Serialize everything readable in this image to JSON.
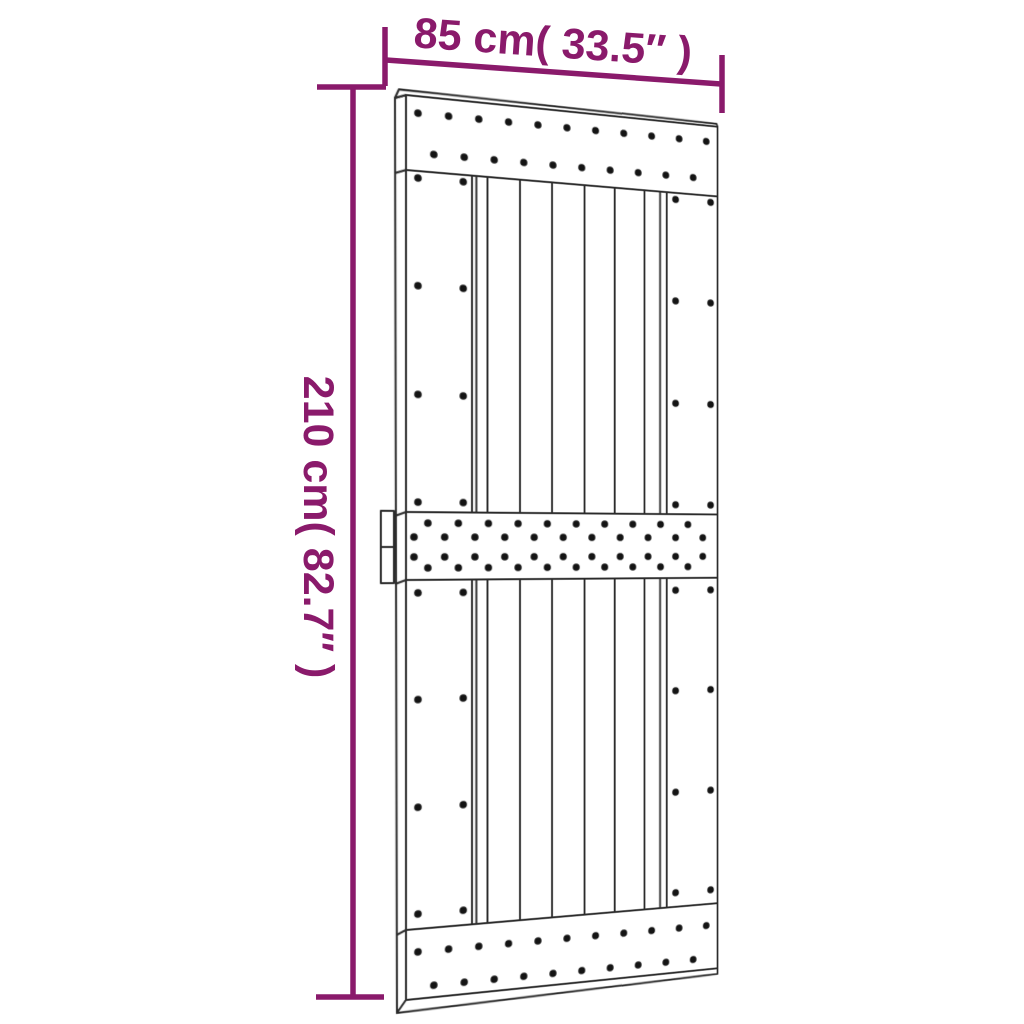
{
  "dimensions": {
    "width_label": "85 cm( 33.5″ )",
    "height_label": "210 cm( 82.7″ )"
  },
  "colors": {
    "annotation": "#8a1a6b",
    "outline": "#2b2b2b",
    "dot": "#141414",
    "background": "#ffffff"
  }
}
